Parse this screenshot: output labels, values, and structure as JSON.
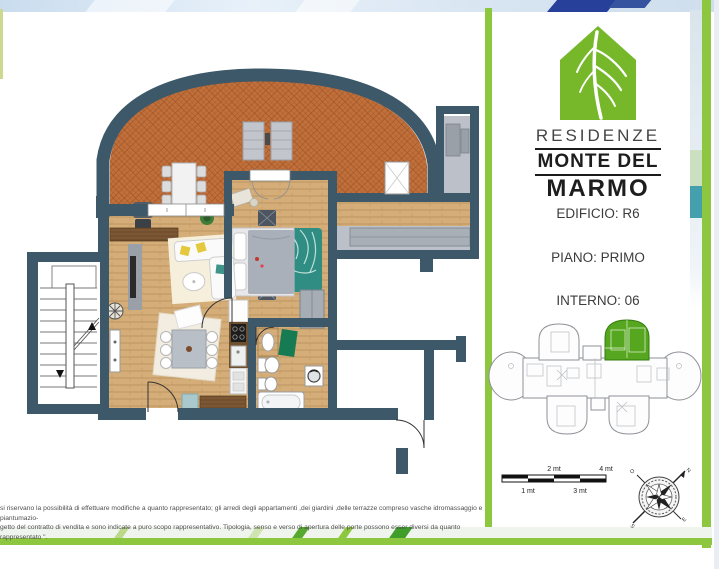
{
  "brand": {
    "residenze": "RESIDENZE",
    "monte_del": "MONTE DEL",
    "marmo": "MARMO"
  },
  "unit_info": {
    "edificio": "EDIFICIO: R6",
    "piano": "PIANO: PRIMO",
    "interno": "INTERNO: 06"
  },
  "scale_bar": {
    "labels_above": [
      "2 mt",
      "4 mt"
    ],
    "labels_below": [
      "1 mt",
      "3 mt"
    ]
  },
  "compass": {
    "north": "N",
    "south": "S",
    "east": "E",
    "west": "O"
  },
  "disclaimer": {
    "line1": "si riservano la possibilità di effettuare modifiche a quanto rappresentato; gli arredi degli appartamenti ,dei giardini ,delle terrazze compreso vasche idromassaggio e piantumazio-",
    "line2": "getto del contratto di vendita e sono indicate a puro scopo rappresentativo. Tipologia, senso e verso di apertura delle porte possono esser diversi da quanto rappresentato \"."
  },
  "colors": {
    "brand_green": "#76b82a",
    "divider_green": "#8dc63f",
    "wall": "#3d5868",
    "terrace_tile": "#c0703a",
    "wood_floor": "#d5ad78",
    "highlight_unit": "#56a71f",
    "accent_teal": "#44a0ad"
  }
}
